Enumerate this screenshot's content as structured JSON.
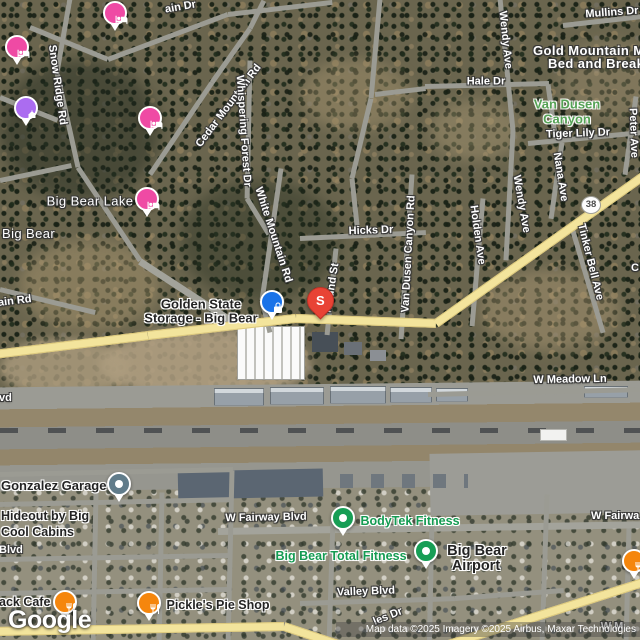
{
  "map_type": "satellite",
  "road_labels": [
    {
      "text": "ain Dr"
    },
    {
      "text": "Mullins Dr"
    },
    {
      "text": "Snow Ridge Rd"
    },
    {
      "text": "Cedar Mountain Rd"
    },
    {
      "text": "Whispering Forest Dr"
    },
    {
      "text": "White Mountain Rd"
    },
    {
      "text": "Hale Dr"
    },
    {
      "text": "Wendy Ave"
    },
    {
      "text": "Tiger Lily Dr"
    },
    {
      "text": "Nana Ave"
    },
    {
      "text": "Peter Ave"
    },
    {
      "text": "Hicks Dr"
    },
    {
      "text": "Mound St"
    },
    {
      "text": "Van Dusen Canyon Rd"
    },
    {
      "text": "Holden Ave"
    },
    {
      "text": "Wendy Ave"
    },
    {
      "text": "Tinker Bell Ave"
    },
    {
      "text": "ain Rd"
    },
    {
      "text": "W Meadow Ln"
    },
    {
      "text": "vd"
    },
    {
      "text": "W Fairway Blvd"
    },
    {
      "text": "W Fairwa"
    },
    {
      "text": "Blvd"
    },
    {
      "text": "Valley Blvd"
    },
    {
      "text": "les Dr"
    },
    {
      "text": "W M"
    },
    {
      "text": "C"
    }
  ],
  "city_labels": [
    {
      "text": "Big Bear Lake"
    },
    {
      "text": "Big Bear"
    }
  ],
  "nature_labels": [
    {
      "line1": "Van Dusen",
      "line2": "Canyon"
    }
  ],
  "poi_labels": [
    {
      "line1": "Gold Mountain M",
      "line2": "Bed and Break"
    },
    {
      "line1": "Golden State",
      "line2": "Storage - Big Bear"
    },
    {
      "text": "Gonzalez Garage"
    },
    {
      "line1": "Hideout by Big",
      "line2": "Cool Cabins"
    },
    {
      "text": "BodyTek Fitness"
    },
    {
      "text": "Big Bear Total Fitness"
    },
    {
      "line1": "Big Bear",
      "line2": "Airport"
    },
    {
      "text": "ack Cafe"
    },
    {
      "text": "Pickle's Pie Shop"
    }
  ],
  "markers": [
    {
      "kind": "lodging"
    },
    {
      "kind": "lodging"
    },
    {
      "kind": "attraction"
    },
    {
      "kind": "lodging"
    },
    {
      "kind": "lodging"
    },
    {
      "kind": "storage"
    },
    {
      "kind": "red-pin",
      "label": "S"
    },
    {
      "kind": "auto-garage"
    },
    {
      "kind": "fitness"
    },
    {
      "kind": "fitness"
    },
    {
      "kind": "restaurant"
    },
    {
      "kind": "restaurant"
    },
    {
      "kind": "restaurant"
    }
  ],
  "route_shield": {
    "text": "38"
  },
  "logo": {
    "text": "Google"
  },
  "attribution": {
    "text": "Map data ©2025 Imagery ©2025 Airbus, Maxar Technologies"
  },
  "colors": {
    "lodging_pink": "#ef4aa4",
    "attraction_purple": "#ab6cf0",
    "storage_blue": "#1a73e8",
    "pin_red": "#e84335",
    "fitness_green": "#179e55",
    "restaurant_orange": "#f5860d",
    "garage_slate": "#617c8a",
    "highway_yellow": "#f3e49c",
    "nature_green": "#55a255",
    "poi_text_green": "#149b52"
  }
}
